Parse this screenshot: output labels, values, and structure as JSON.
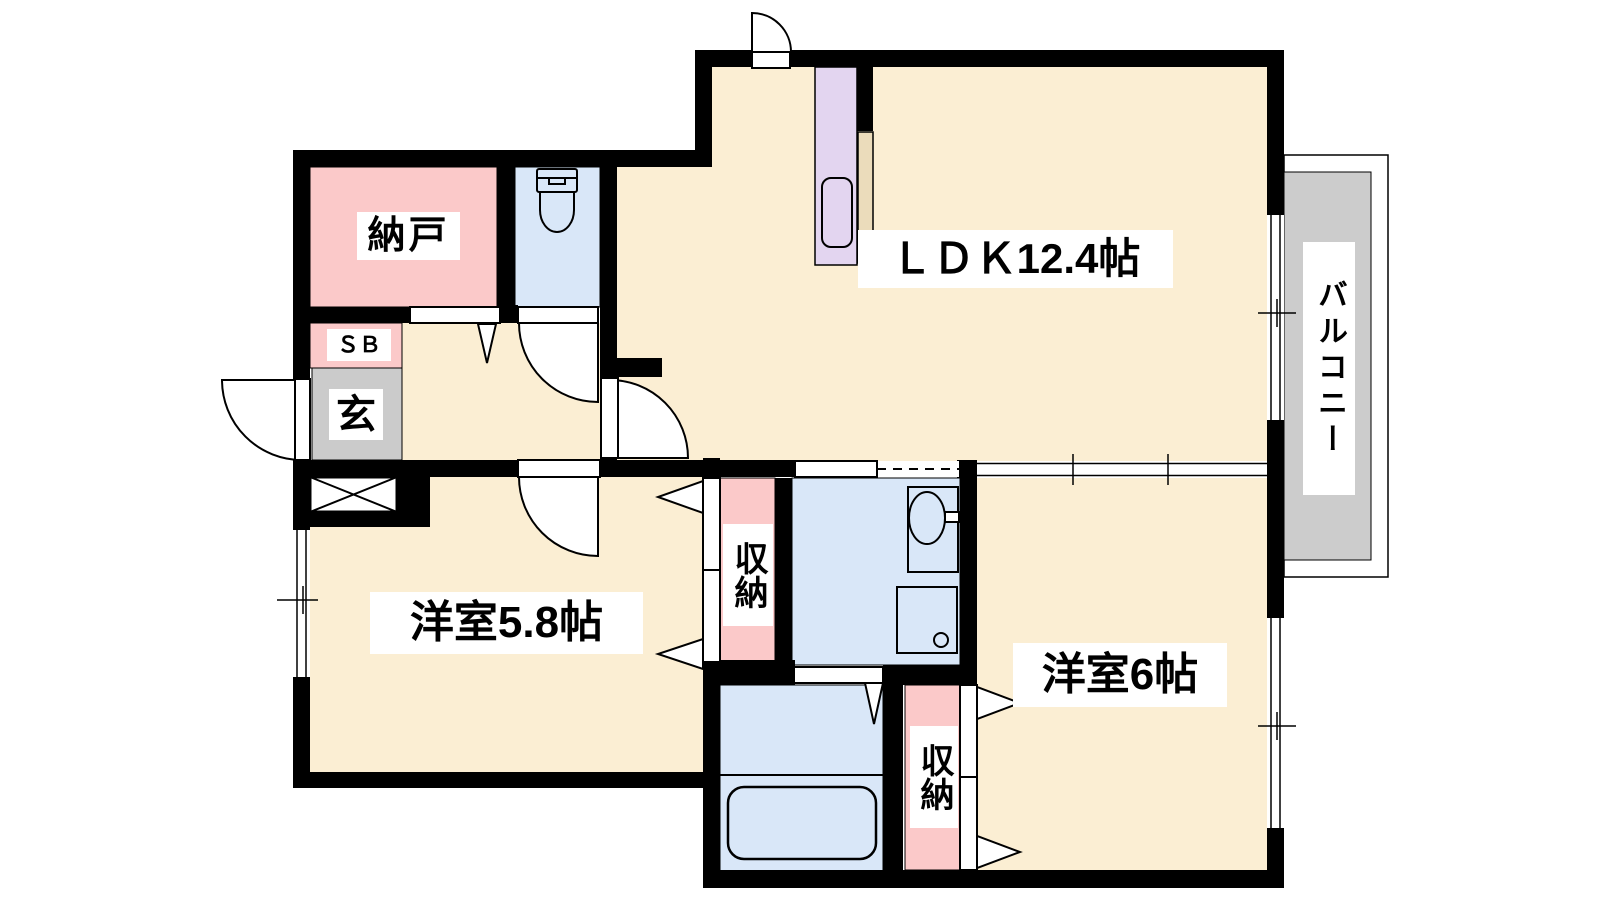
{
  "floorplan": {
    "type": "apartment-floorplan",
    "labels": {
      "ldk": "ＬＤＫ12.4帖",
      "storage_room": "納戸",
      "shoe_box": "ＳＢ",
      "entrance": "玄",
      "western_room_58": "洋室5.8帖",
      "western_room_6": "洋室6帖",
      "closet_left": "収納",
      "closet_right": "収納",
      "balcony": "バルコニー"
    },
    "fixtures": [
      "toilet",
      "kitchen-sink",
      "counter",
      "washbasin",
      "washing-machine-pan",
      "bathtub",
      "meter-box"
    ],
    "colors": {
      "background": "#FFFFFF",
      "room_floor": "#FBEED3",
      "storage_pink": "#FBC9C9",
      "wet_area_blue": "#D9E7F8",
      "entrance_gray": "#CBCBCB",
      "balcony_gray": "#CCCCCC",
      "kitchen_lavender": "#E3D5F0",
      "counter_tan": "#EBDCBB",
      "wall": "#000000"
    }
  }
}
